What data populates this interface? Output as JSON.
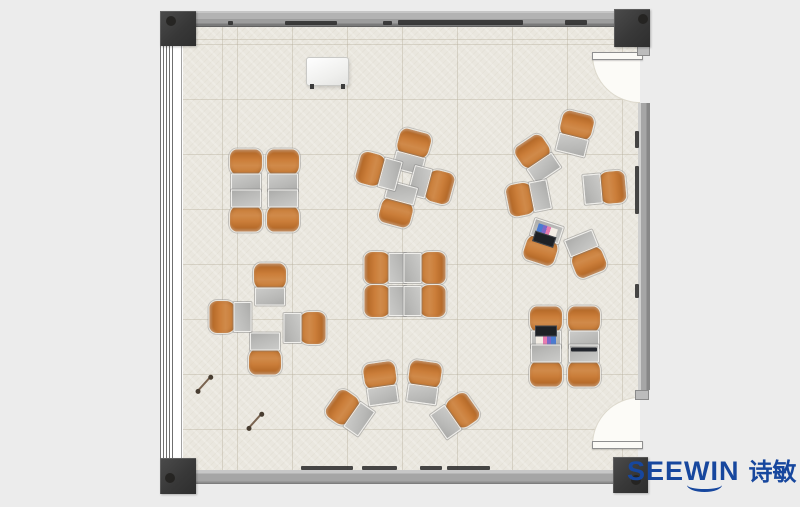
{
  "brand": {
    "name": "SEEWIN",
    "cjk": "诗敏",
    "color": "#17479E"
  },
  "plan": {
    "colors": {
      "floor": "#EAE7DF",
      "wall": "#A8A8A8",
      "pillar": "#3D3D3D",
      "chair": "#C77A33",
      "desk": "#BFBFBF",
      "door_swing": "#FCFBF7"
    },
    "pillars": [
      {
        "x": 160,
        "y": 11,
        "w": 36,
        "h": 35,
        "dot": [
          6,
          5
        ]
      },
      {
        "x": 614,
        "y": 9,
        "w": 36,
        "h": 38,
        "dot": [
          24,
          5
        ]
      },
      {
        "x": 160,
        "y": 458,
        "w": 36,
        "h": 36,
        "dot": [
          5,
          15
        ]
      },
      {
        "x": 613,
        "y": 457,
        "w": 35,
        "h": 36,
        "dot": [
          18,
          18
        ]
      }
    ],
    "wall_marks": [
      [
        228,
        21,
        5,
        4
      ],
      [
        285,
        21,
        52,
        4
      ],
      [
        383,
        21,
        9,
        4
      ],
      [
        398,
        20,
        125,
        5
      ],
      [
        565,
        20,
        22,
        5
      ],
      [
        635,
        131,
        4,
        17
      ],
      [
        635,
        166,
        4,
        48
      ],
      [
        635,
        284,
        4,
        14
      ],
      [
        301,
        466,
        52,
        4
      ],
      [
        362,
        466,
        35,
        4
      ],
      [
        420,
        466,
        22,
        4
      ],
      [
        447,
        466,
        43,
        4
      ]
    ],
    "whiteboard": {
      "x": 306,
      "y": 57,
      "w": 41,
      "h": 27
    },
    "pens": [
      {
        "x": 204,
        "y": 383,
        "r": -48
      },
      {
        "x": 255,
        "y": 420,
        "r": -48
      }
    ],
    "clusters": [
      {
        "name": "team-table-northwest",
        "units": [
          [
            246,
            170,
            0
          ],
          [
            283,
            170,
            0
          ],
          [
            246,
            211,
            180
          ],
          [
            283,
            211,
            180
          ]
        ]
      },
      {
        "name": "pinwheel-north",
        "units": [
          [
            412,
            151,
            15
          ],
          [
            432,
            185,
            105
          ],
          [
            398,
            205,
            195
          ],
          [
            378,
            171,
            285
          ]
        ]
      },
      {
        "name": "discussion-circle-east",
        "units": [
          [
            575,
            133,
            14
          ],
          [
            537,
            158,
            -34
          ],
          [
            528,
            198,
            -101
          ],
          [
            543,
            243,
            198,
            "laptop-open"
          ],
          [
            586,
            255,
            158
          ],
          [
            605,
            188,
            85
          ]
        ]
      },
      {
        "name": "pinwheel-west",
        "units": [
          [
            270,
            284,
            0
          ],
          [
            305,
            328,
            90
          ],
          [
            265,
            354,
            180
          ],
          [
            230,
            317,
            270
          ]
        ]
      },
      {
        "name": "team-table-center",
        "units": [
          [
            385,
            268,
            -90
          ],
          [
            385,
            301,
            -90
          ],
          [
            425,
            268,
            90
          ],
          [
            425,
            301,
            90
          ]
        ]
      },
      {
        "name": "arc-south",
        "units": [
          [
            349,
            412,
            -55
          ],
          [
            381,
            383,
            -8
          ],
          [
            424,
            382,
            8
          ],
          [
            456,
            415,
            55
          ]
        ]
      },
      {
        "name": "team-table-southeast",
        "units": [
          [
            546,
            327,
            0,
            "laptop-open"
          ],
          [
            584,
            327,
            0
          ],
          [
            546,
            366,
            180
          ],
          [
            584,
            366,
            180,
            "laptop-closed"
          ]
        ]
      }
    ]
  }
}
